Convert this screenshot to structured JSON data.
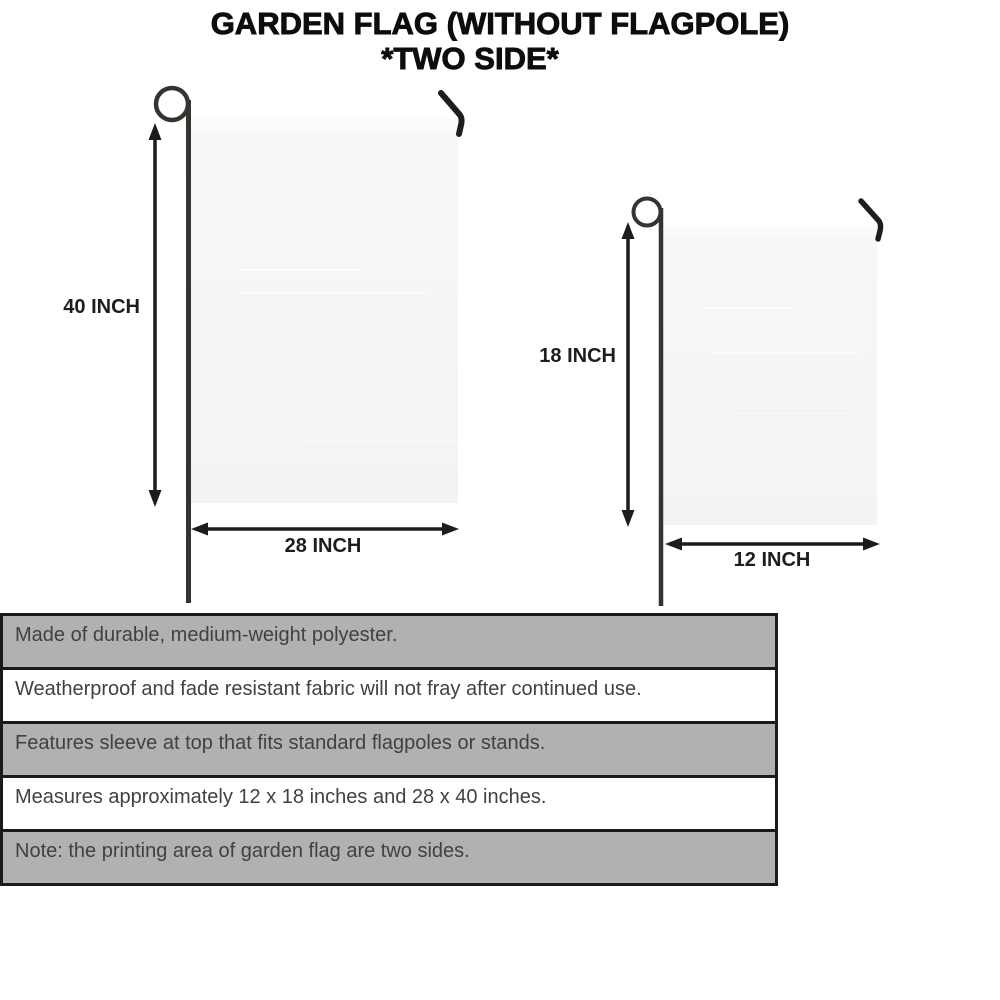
{
  "title": {
    "line1": "GARDEN FLAG (WITHOUT FLAGPOLE)",
    "line2": "*TWO SIDE*"
  },
  "flags": {
    "large": {
      "height_label": "40 INCH",
      "width_label": "28 INCH"
    },
    "small": {
      "height_label": "18 INCH",
      "width_label": "12 INCH"
    }
  },
  "features": {
    "rows": [
      {
        "text": "Made of durable, medium-weight polyester.",
        "shaded": true
      },
      {
        "text": "Weatherproof and fade resistant fabric will not fray after continued use.",
        "shaded": false
      },
      {
        "text": "Features sleeve at top that fits standard flagpoles or stands.",
        "shaded": true
      },
      {
        "text": "Measures approximately 12 x 18 inches and 28 x 40 inches.",
        "shaded": false
      },
      {
        "text": "Note: the printing area of garden flag are two sides.",
        "shaded": true
      }
    ]
  },
  "colors": {
    "row_shaded": "#b1b1b1",
    "row_plain": "#ffffff",
    "row_border": "#1a1a1a",
    "row_text": "#414141",
    "flag_fill": "#f5f5f5",
    "pole": "#35342f",
    "arrow": "#1c1c1c",
    "title_text": "#0d0d0d"
  }
}
